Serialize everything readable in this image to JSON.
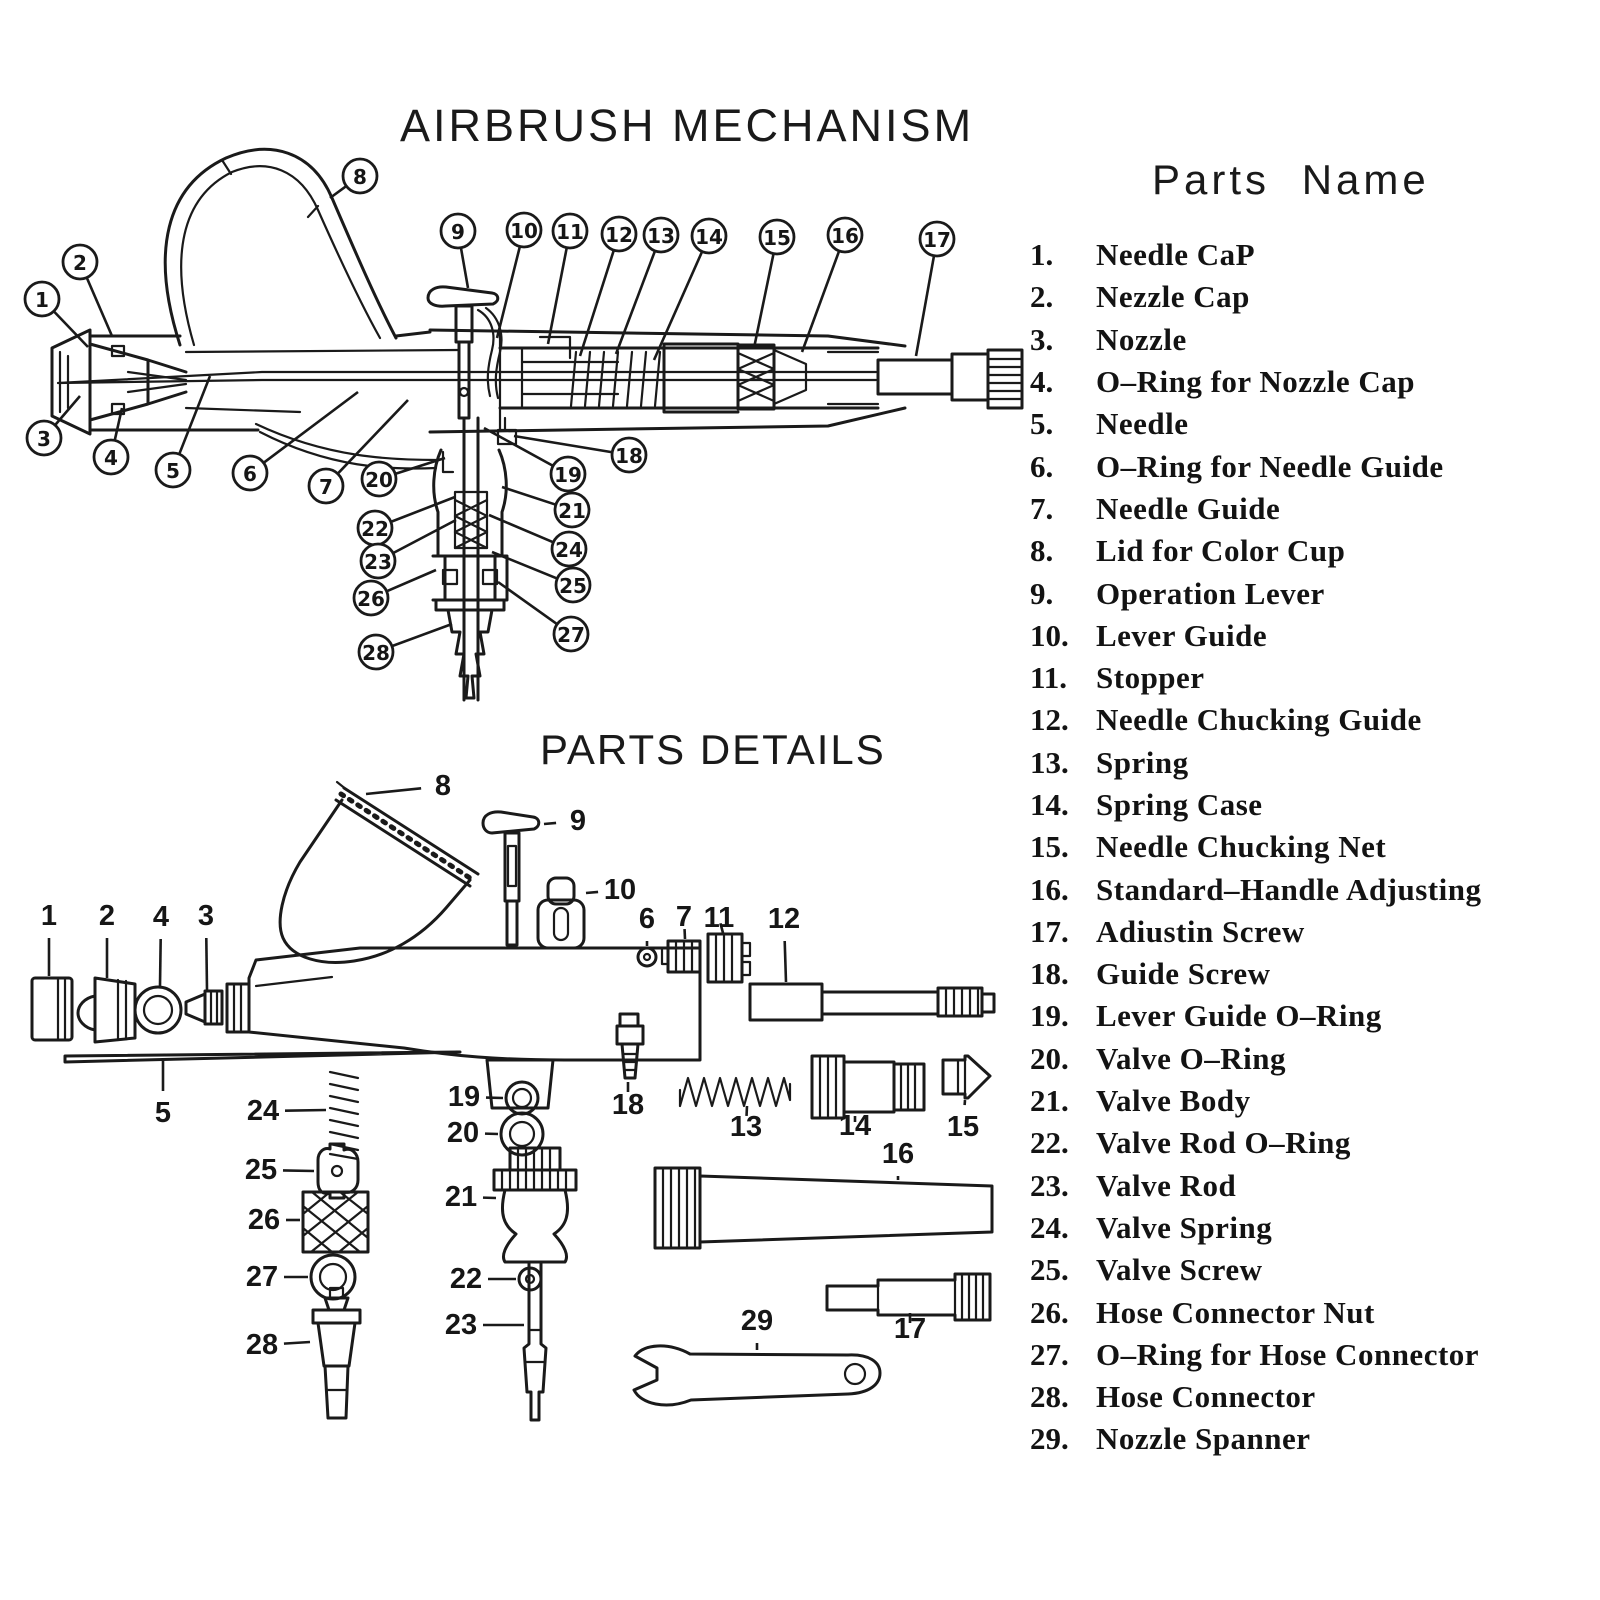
{
  "page": {
    "bg_color": "#ffffff",
    "ink_color": "#1a1a1a"
  },
  "mechanism_diagram": {
    "title": "AIRBRUSH MECHANISM",
    "callouts": [
      {
        "n": "1",
        "x": 42,
        "y": 299,
        "tx": 88,
        "ty": 347
      },
      {
        "n": "2",
        "x": 80,
        "y": 262,
        "tx": 112,
        "ty": 336
      },
      {
        "n": "3",
        "x": 44,
        "y": 438,
        "tx": 80,
        "ty": 396
      },
      {
        "n": "4",
        "x": 111,
        "y": 457,
        "tx": 122,
        "ty": 408
      },
      {
        "n": "5",
        "x": 173,
        "y": 470,
        "tx": 210,
        "ty": 376
      },
      {
        "n": "6",
        "x": 250,
        "y": 473,
        "tx": 358,
        "ty": 392
      },
      {
        "n": "7",
        "x": 326,
        "y": 486,
        "tx": 408,
        "ty": 400
      },
      {
        "n": "8",
        "x": 360,
        "y": 176,
        "tx": 330,
        "ty": 198
      },
      {
        "n": "9",
        "x": 458,
        "y": 231,
        "tx": 468,
        "ty": 288
      },
      {
        "n": "10",
        "x": 524,
        "y": 230,
        "tx": 497,
        "ty": 338
      },
      {
        "n": "11",
        "x": 570,
        "y": 231,
        "tx": 548,
        "ty": 344
      },
      {
        "n": "12",
        "x": 619,
        "y": 234,
        "tx": 580,
        "ty": 356
      },
      {
        "n": "13",
        "x": 661,
        "y": 235,
        "tx": 616,
        "ty": 354
      },
      {
        "n": "14",
        "x": 709,
        "y": 236,
        "tx": 654,
        "ty": 360
      },
      {
        "n": "15",
        "x": 777,
        "y": 237,
        "tx": 754,
        "ty": 348
      },
      {
        "n": "16",
        "x": 845,
        "y": 235,
        "tx": 802,
        "ty": 352
      },
      {
        "n": "17",
        "x": 937,
        "y": 239,
        "tx": 916,
        "ty": 356
      },
      {
        "n": "18",
        "x": 629,
        "y": 455,
        "tx": 514,
        "ty": 436
      },
      {
        "n": "19",
        "x": 568,
        "y": 474,
        "tx": 484,
        "ty": 428
      },
      {
        "n": "20",
        "x": 379,
        "y": 479,
        "tx": 445,
        "ty": 458
      },
      {
        "n": "21",
        "x": 572,
        "y": 510,
        "tx": 502,
        "ty": 487
      },
      {
        "n": "22",
        "x": 375,
        "y": 528,
        "tx": 455,
        "ty": 497
      },
      {
        "n": "23",
        "x": 378,
        "y": 561,
        "tx": 456,
        "ty": 520
      },
      {
        "n": "24",
        "x": 569,
        "y": 549,
        "tx": 489,
        "ty": 515
      },
      {
        "n": "25",
        "x": 573,
        "y": 585,
        "tx": 492,
        "ty": 552
      },
      {
        "n": "26",
        "x": 371,
        "y": 598,
        "tx": 436,
        "ty": 570
      },
      {
        "n": "27",
        "x": 571,
        "y": 634,
        "tx": 498,
        "ty": 582
      },
      {
        "n": "28",
        "x": 376,
        "y": 652,
        "tx": 452,
        "ty": 624
      }
    ]
  },
  "details_diagram": {
    "title": "PARTS DETAILS",
    "labels": [
      {
        "n": "1",
        "x": 49,
        "y": 916,
        "tx": 49,
        "ty": 976
      },
      {
        "n": "2",
        "x": 107,
        "y": 916,
        "tx": 107,
        "ty": 978
      },
      {
        "n": "4",
        "x": 161,
        "y": 917,
        "tx": 160,
        "ty": 986
      },
      {
        "n": "3",
        "x": 206,
        "y": 916,
        "tx": 207,
        "ty": 990
      },
      {
        "n": "8",
        "x": 443,
        "y": 786,
        "tx": 366,
        "ty": 794
      },
      {
        "n": "9",
        "x": 578,
        "y": 821,
        "tx": 544,
        "ty": 824
      },
      {
        "n": "10",
        "x": 620,
        "y": 890,
        "tx": 586,
        "ty": 893
      },
      {
        "n": "6",
        "x": 647,
        "y": 919,
        "tx": 647,
        "ty": 946
      },
      {
        "n": "7",
        "x": 684,
        "y": 917,
        "tx": 685,
        "ty": 939
      },
      {
        "n": "11",
        "x": 719,
        "y": 918,
        "tx": 723,
        "ty": 933
      },
      {
        "n": "12",
        "x": 784,
        "y": 919,
        "tx": 786,
        "ty": 982
      },
      {
        "n": "5",
        "x": 163,
        "y": 1113,
        "tx": 163,
        "ty": 1058
      },
      {
        "n": "24",
        "x": 263,
        "y": 1111,
        "tx": 326,
        "ty": 1110
      },
      {
        "n": "25",
        "x": 261,
        "y": 1170,
        "tx": 314,
        "ty": 1171
      },
      {
        "n": "26",
        "x": 264,
        "y": 1220,
        "tx": 300,
        "ty": 1220
      },
      {
        "n": "27",
        "x": 262,
        "y": 1277,
        "tx": 308,
        "ty": 1277
      },
      {
        "n": "28",
        "x": 262,
        "y": 1345,
        "tx": 310,
        "ty": 1342
      },
      {
        "n": "19",
        "x": 464,
        "y": 1097,
        "tx": 503,
        "ty": 1098
      },
      {
        "n": "20",
        "x": 463,
        "y": 1133,
        "tx": 498,
        "ty": 1134
      },
      {
        "n": "21",
        "x": 461,
        "y": 1197,
        "tx": 496,
        "ty": 1198
      },
      {
        "n": "22",
        "x": 466,
        "y": 1279,
        "tx": 516,
        "ty": 1279
      },
      {
        "n": "23",
        "x": 461,
        "y": 1325,
        "tx": 524,
        "ty": 1325
      },
      {
        "n": "18",
        "x": 628,
        "y": 1105,
        "tx": 628,
        "ty": 1082
      },
      {
        "n": "13",
        "x": 746,
        "y": 1127,
        "tx": 747,
        "ty": 1106
      },
      {
        "n": "14",
        "x": 855,
        "y": 1126,
        "tx": 855,
        "ty": 1116
      },
      {
        "n": "15",
        "x": 963,
        "y": 1127,
        "tx": 965,
        "ty": 1100
      },
      {
        "n": "16",
        "x": 898,
        "y": 1154,
        "tx": 898,
        "ty": 1180
      },
      {
        "n": "17",
        "x": 910,
        "y": 1329,
        "tx": 910,
        "ty": 1313
      },
      {
        "n": "29",
        "x": 757,
        "y": 1321,
        "tx": 757,
        "ty": 1350
      }
    ]
  },
  "parts_list": {
    "heading": "Parts Name",
    "items": [
      {
        "num": "1.",
        "name": "Needle CaP"
      },
      {
        "num": "2.",
        "name": "Nezzle Cap"
      },
      {
        "num": "3.",
        "name": "Nozzle"
      },
      {
        "num": "4.",
        "name": "O–Ring for Nozzle Cap"
      },
      {
        "num": "5.",
        "name": "Needle"
      },
      {
        "num": "6.",
        "name": "O–Ring for Needle Guide"
      },
      {
        "num": "7.",
        "name": "Needle Guide"
      },
      {
        "num": "8.",
        "name": "Lid for Color Cup"
      },
      {
        "num": "9.",
        "name": "Operation Lever"
      },
      {
        "num": "10.",
        "name": "Lever Guide"
      },
      {
        "num": "11.",
        "name": "Stopper"
      },
      {
        "num": "12.",
        "name": "Needle Chucking Guide"
      },
      {
        "num": "13.",
        "name": "Spring"
      },
      {
        "num": "14.",
        "name": "Spring Case"
      },
      {
        "num": "15.",
        "name": "Needle Chucking Net"
      },
      {
        "num": "16.",
        "name": "Standard–Handle Adjusting"
      },
      {
        "num": "17.",
        "name": "Adiustin Screw"
      },
      {
        "num": "18.",
        "name": "Guide Screw"
      },
      {
        "num": "19.",
        "name": "Lever Guide O–Ring"
      },
      {
        "num": "20.",
        "name": "Valve O–Ring"
      },
      {
        "num": "21.",
        "name": "Valve Body"
      },
      {
        "num": "22.",
        "name": "Valve Rod O–Ring"
      },
      {
        "num": "23.",
        "name": "Valve Rod"
      },
      {
        "num": "24.",
        "name": "Valve Spring"
      },
      {
        "num": "25.",
        "name": "Valve Screw"
      },
      {
        "num": "26.",
        "name": "Hose Connector Nut"
      },
      {
        "num": "27.",
        "name": "O–Ring for Hose Connector"
      },
      {
        "num": "28.",
        "name": "Hose Connector"
      },
      {
        "num": "29.",
        "name": "Nozzle Spanner"
      }
    ]
  }
}
